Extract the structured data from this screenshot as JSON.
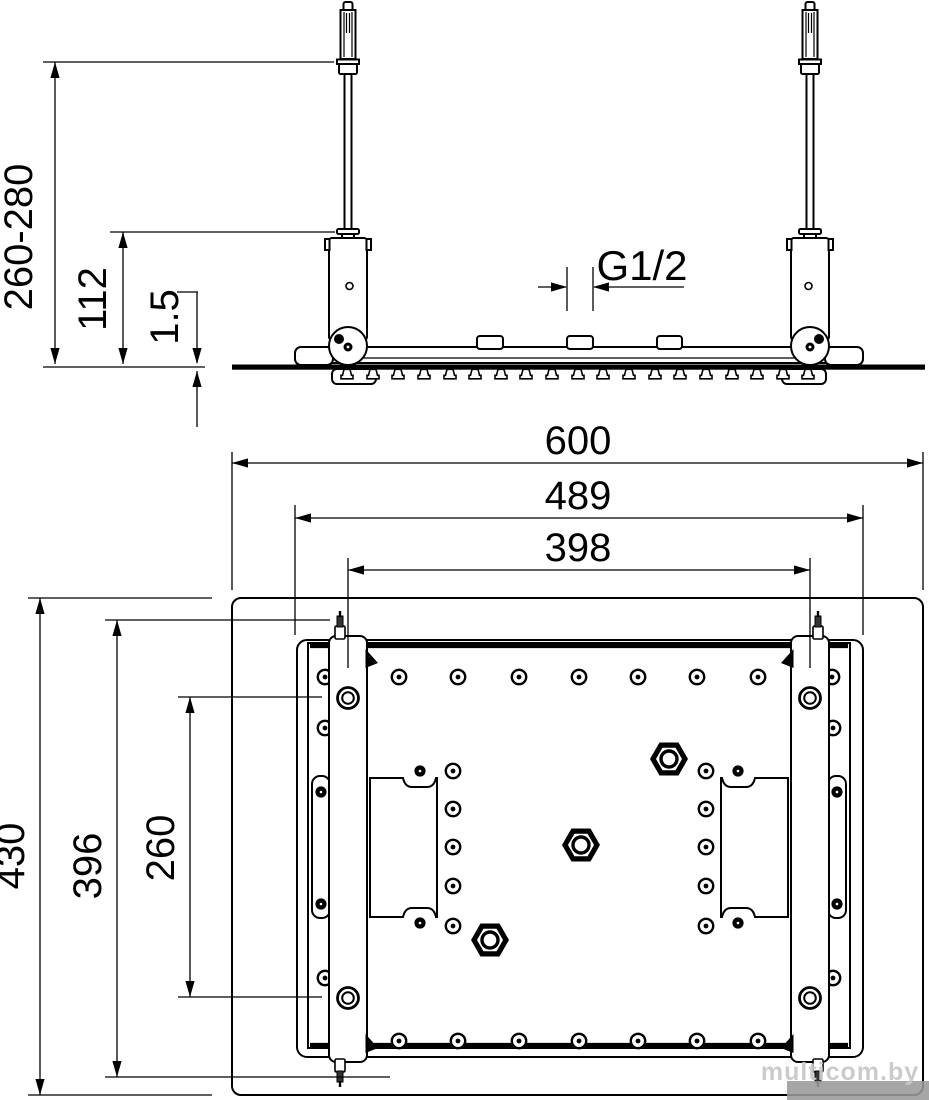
{
  "drawing": {
    "type": "technical dimension drawing",
    "views": [
      "front elevation",
      "bottom plan"
    ]
  },
  "elevation": {
    "dims": {
      "height_range": "260-280",
      "bracket_height": "112",
      "plate_thickness": "1.5",
      "thread_size": "G1/2"
    }
  },
  "plan": {
    "dims": {
      "overall_width": "600",
      "body_width": "489",
      "rail_spacing": "398",
      "overall_depth": "430",
      "stud_span": "396",
      "hole_spacing": "260"
    }
  },
  "watermark": {
    "text": "multicom.by"
  }
}
